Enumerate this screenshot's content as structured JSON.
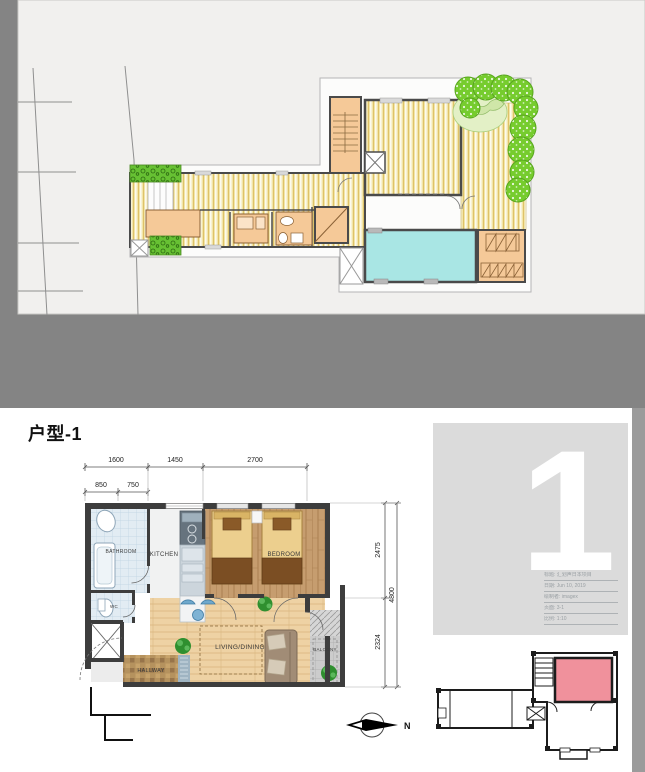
{
  "unit_page": {
    "title": "户型-1",
    "unit_number": "1",
    "north_label": "N",
    "dimensions": {
      "top_row": [
        "1600",
        "1450",
        "2700"
      ],
      "top_sub_row": [
        "850",
        "750"
      ],
      "right_segments": [
        "2475",
        "2324"
      ],
      "right_total": "4800"
    },
    "room_labels": {
      "bathroom": "BATHROOM",
      "wc": "WC",
      "kitchen": "KITCHEN",
      "bedroom": "BEDROOM",
      "living_dining": "LIVING/DINING",
      "hallway": "HALLWAY",
      "balcony": "BALCONY"
    },
    "title_block": [
      "标题: 汇划声日本项目",
      "日期: Jun 10, 2019",
      "绘制者: imagex",
      "页面: 3-1",
      "比例: 1:10"
    ]
  },
  "colors": {
    "background_gray": "#848484",
    "paper": "#f1f0ee",
    "deck_yellow": "#f2e5a8",
    "pool_cyan": "#a9e6e4",
    "tree_green": "#76cc2e",
    "furniture_orange": "#f5c998",
    "wall_dark": "#3d3d3d",
    "unit_highlight_pink": "#f0919c",
    "panel_gray": "#dbdbdb"
  }
}
